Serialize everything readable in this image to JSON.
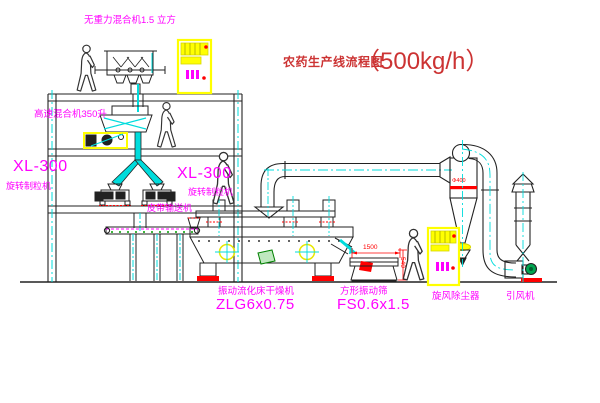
{
  "title": {
    "name": "农药生产线流程图",
    "capacity": "（500kg/h）"
  },
  "equipment_labels": {
    "gravity_free_mixer": "无重力混合机1.5 立方",
    "high_speed_mixer": "高速混合机350升",
    "granulator_left": {
      "model": "XL-300",
      "name": "旋转制粒机"
    },
    "granulator_right": {
      "model": "XL-300",
      "name": "旋转制粒机"
    },
    "belt_conveyor": "皮带输送机",
    "fluid_bed_dryer": {
      "name": "振动流化床干燥机",
      "model": "ZLG6x0.75"
    },
    "vibrating_screen": {
      "name": "方形振动筛",
      "model": "FS0.6x1.5"
    },
    "cyclone": "旋风除尘器",
    "induced_draft_fan": "引风机"
  },
  "dimensions": {
    "cyclone_diameter": "Φ400",
    "screen_length": "1500",
    "screen_height": "540"
  },
  "colors": {
    "label_magenta": "#ff00ff",
    "title_red": "#cc3333",
    "centerline_cyan": "#00dcdc",
    "drawing_line": "#222222",
    "cabinet_yellow": "#ffff00",
    "alert_red": "#ff0000",
    "motor_green": "#00a550"
  }
}
